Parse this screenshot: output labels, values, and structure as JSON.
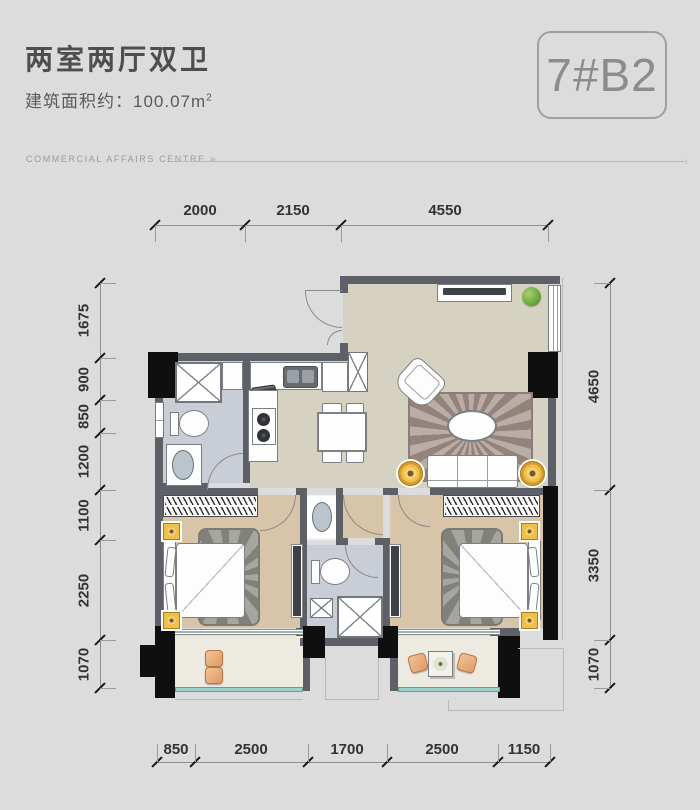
{
  "header": {
    "title": "两室两厅双卫",
    "area_label": "建筑面积约：100.07m",
    "area_sup": "2",
    "badge": "7#B2",
    "tagline": "COMMERCIAL AFFAIRS CENTRE",
    "tagline_arrow": "»",
    "rule_arrow": "›"
  },
  "dimensions": {
    "top": [
      "2000",
      "2150",
      "4550"
    ],
    "left": [
      "1675",
      "900",
      "850",
      "1200",
      "1100",
      "2250",
      "1070"
    ],
    "right": [
      "4650",
      "3350",
      "1070"
    ],
    "bottom": [
      "850",
      "2500",
      "1700",
      "2500",
      "1150"
    ]
  },
  "colors": {
    "bg": "#dcdcdc",
    "wall": "#5d6066",
    "black": "#0f0f0f",
    "floor_living": "#d5d2c2",
    "floor_bed": "#d8c4a9",
    "floor_bath": "#c9cdd5",
    "floor_balcony": "#edeae1",
    "floor_niche": "#eef0f1",
    "accent_yellow": "#eec04a",
    "accent_orange": "#e09a64",
    "rug_living": "#a5968d",
    "rug_bed": "#90908a",
    "plant_green": "#6aa83e",
    "glass": "#9ad2c8",
    "appliance": "#3e4247",
    "furn_stroke": "#7c8085",
    "dim_text": "#333333",
    "dim_line": "#8f8f8f",
    "title": "#4e4e4e",
    "subtitle": "#5a5a5a",
    "tagline": "#9b9b9b",
    "badge_text": "#8c8c8c",
    "badge_border": "#a0a0a0",
    "line": "#b9b9b9"
  }
}
